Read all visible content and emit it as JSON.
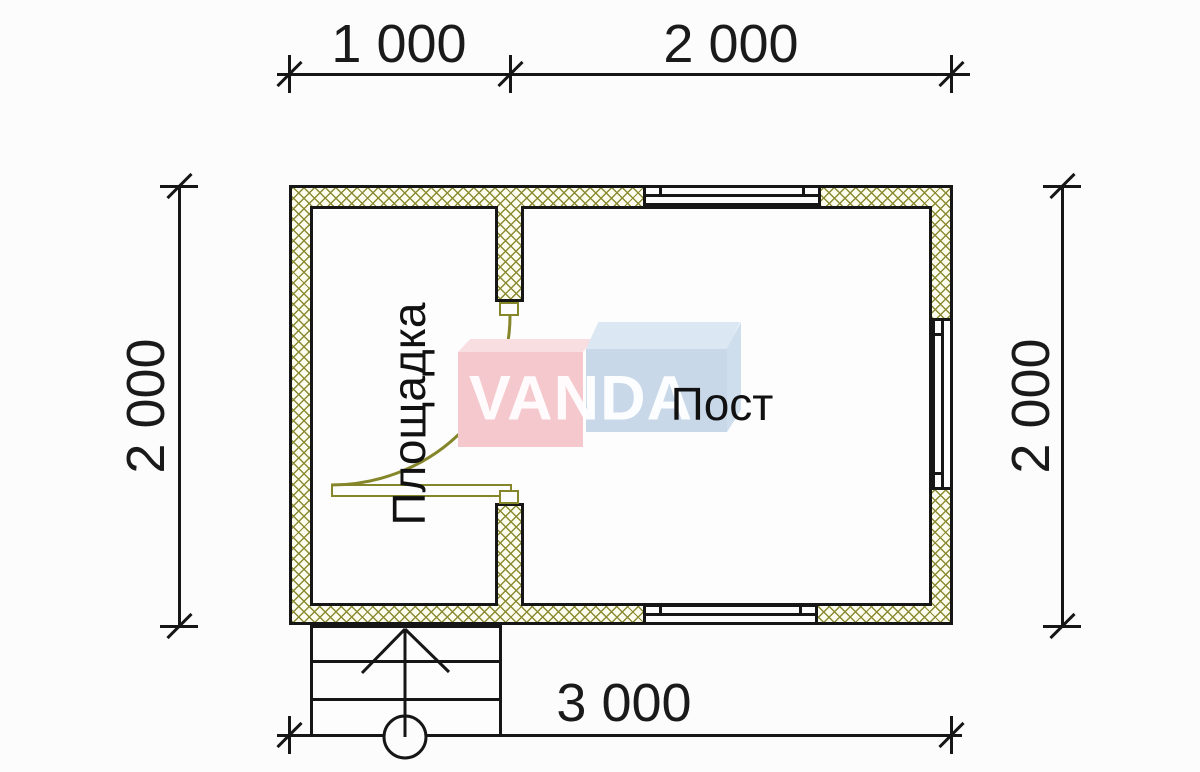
{
  "dimensions": {
    "top_left": "1 000",
    "top_right": "2 000",
    "left": "2 000",
    "right": "2 000",
    "bottom": "3 000"
  },
  "rooms": {
    "left": "Площадка",
    "right": "Пост"
  },
  "watermark": {
    "text": "VANDA"
  },
  "colors": {
    "ink": "#161616",
    "wall_hatch": "#8b8b33",
    "wall_fill": "#fdfdef",
    "door_olive": "#85852a",
    "watermark_pink": "#f4c8cd",
    "watermark_pink_top": "#f8dde1",
    "watermark_blue": "#c8d8e9",
    "watermark_blue_top": "#dbe7f3",
    "watermark_letters": "#ffffff",
    "background": "#fcfcfc"
  }
}
